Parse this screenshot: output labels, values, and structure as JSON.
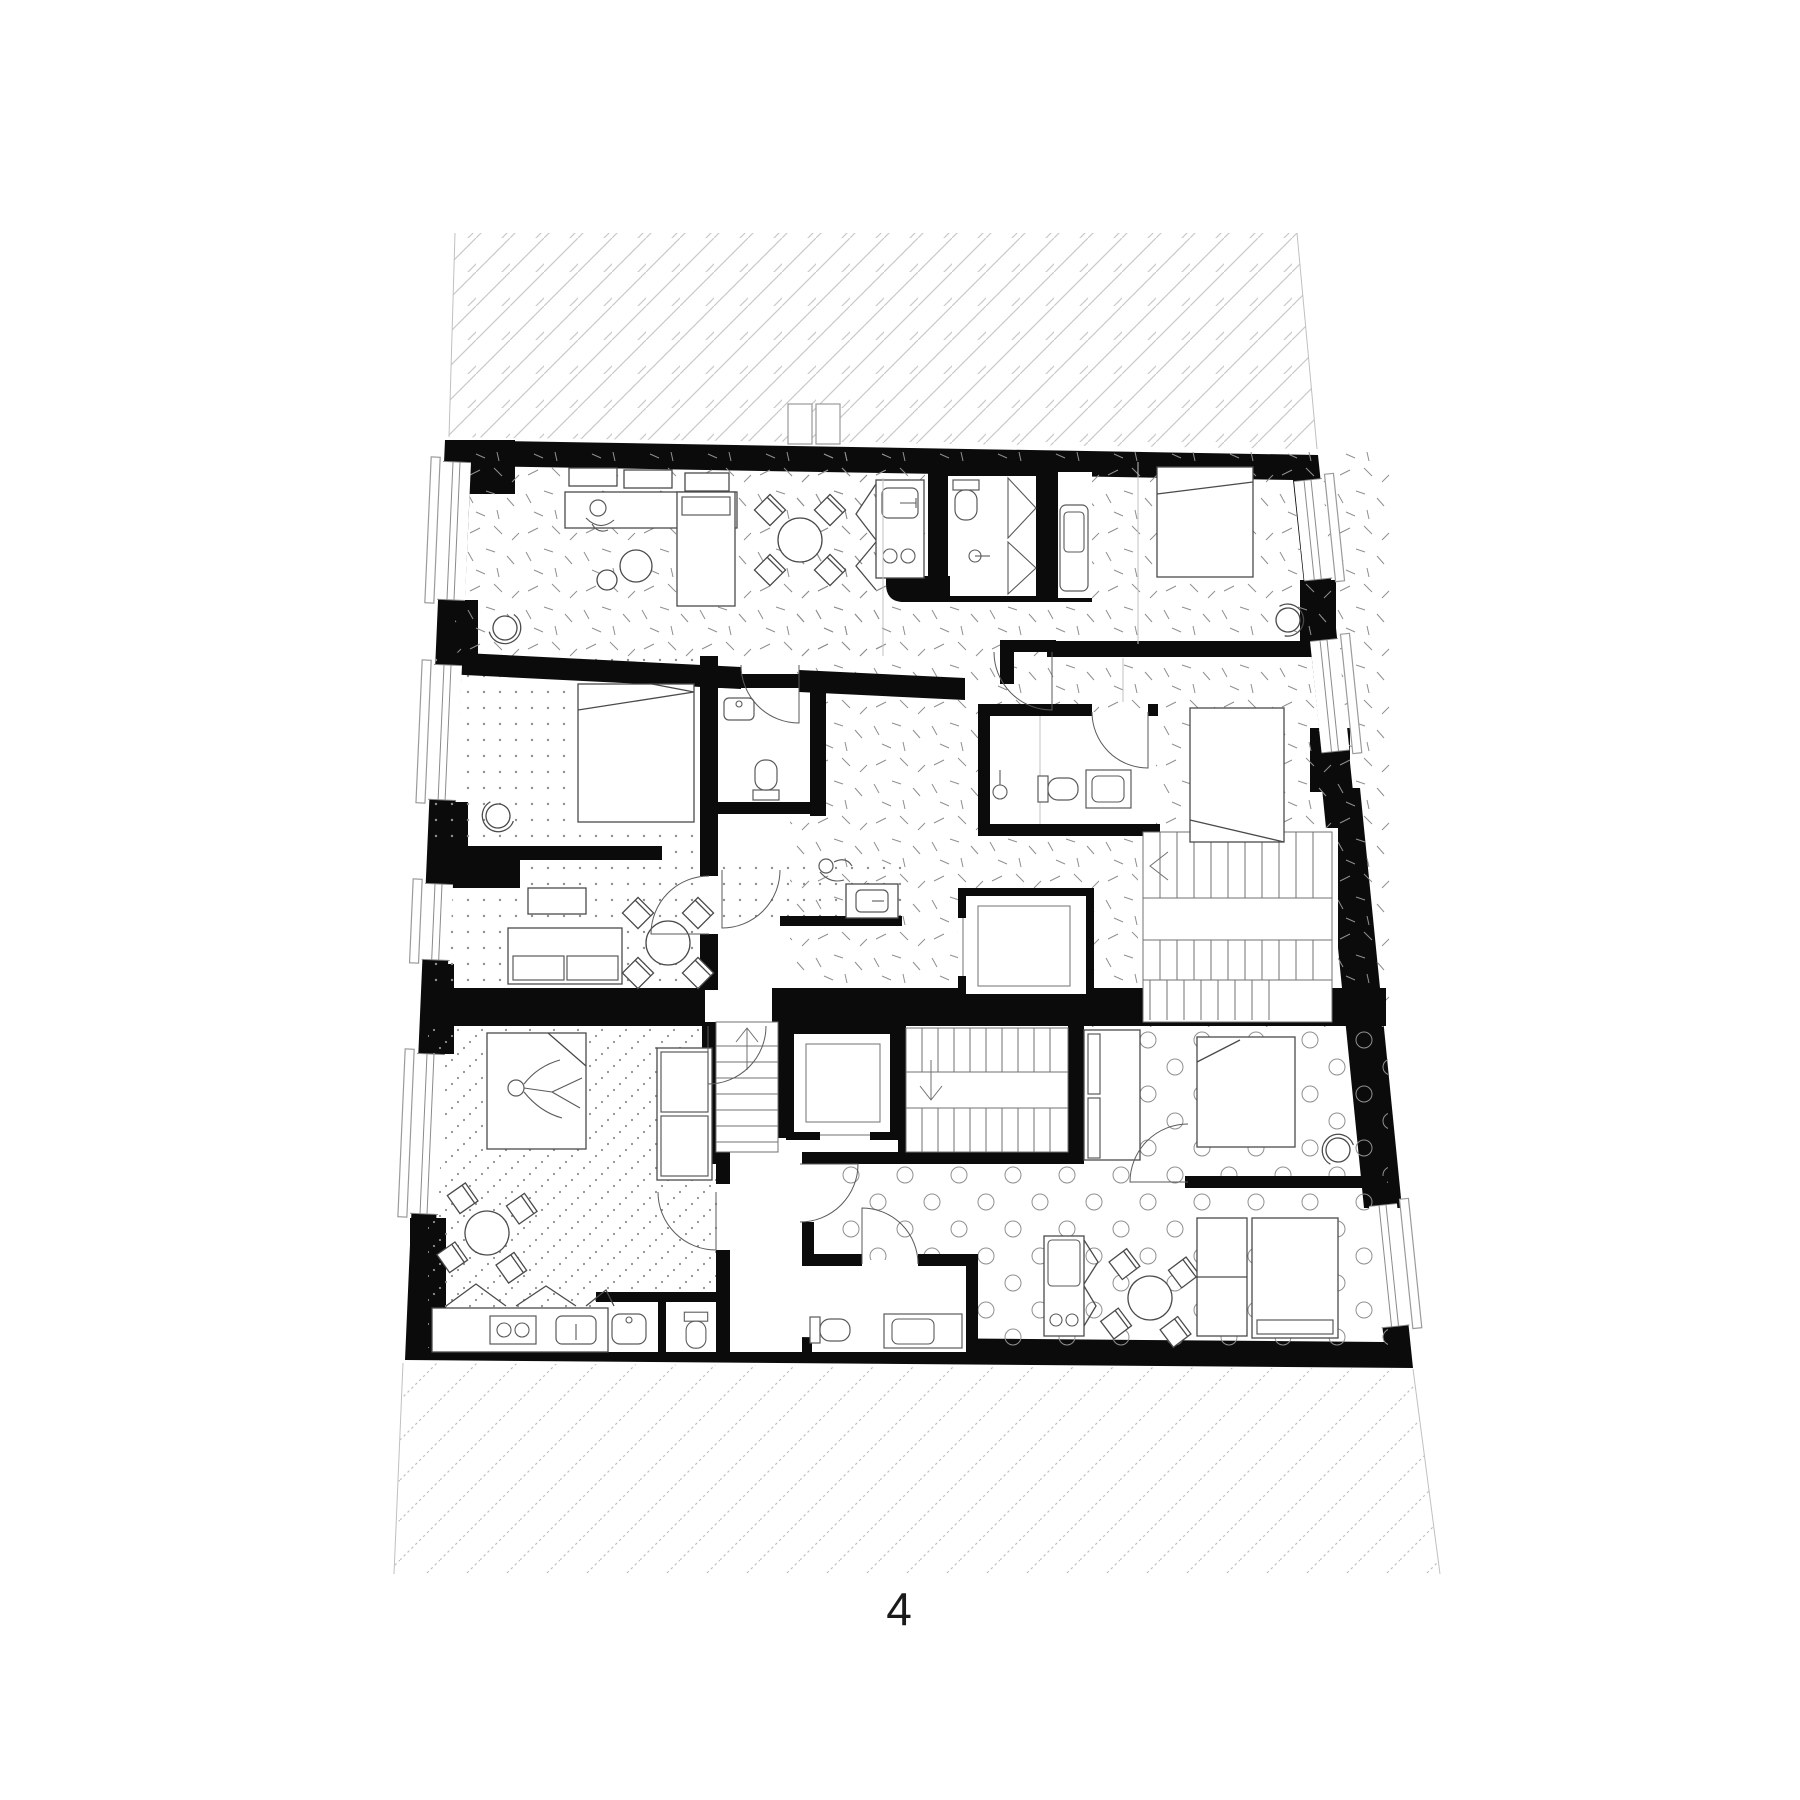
{
  "page": {
    "background": "#ffffff"
  },
  "floor_plan": {
    "floor_label": "4",
    "colors": {
      "paper": "#ffffff",
      "wall": "#0b0b0b",
      "hatch": "#c9c9c9",
      "hatch-dotted": "#c2c2c2",
      "furniture": "#4a4a4a",
      "fixture": "#5a5a5a",
      "texture": "#8f8f8f",
      "stair": "#707070",
      "railing": "#9a9a9a",
      "label": "#1a1a1a"
    },
    "symbols": [
      "double-bed",
      "single-bed",
      "round-dining-table",
      "diamond-chair",
      "tub-chair",
      "sofa",
      "coffee-table",
      "wardrobe",
      "kitchen-counter",
      "sink",
      "stove-burners",
      "fridge",
      "toilet",
      "washbasin",
      "shower",
      "washing-machine",
      "stairs",
      "elevator",
      "door-swing",
      "window-balcony",
      "person"
    ]
  }
}
